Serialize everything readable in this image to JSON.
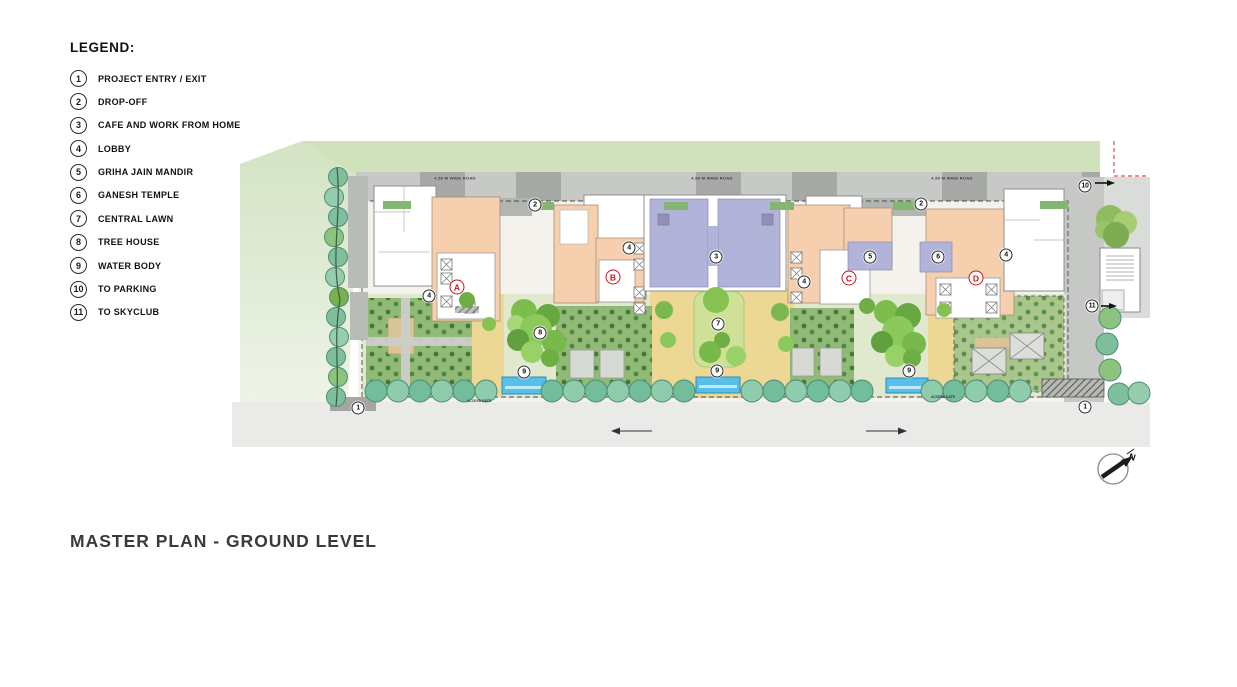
{
  "title": "MASTER PLAN - GROUND LEVEL",
  "legend": {
    "heading": "LEGEND:",
    "items": [
      {
        "num": "1",
        "label": "PROJECT ENTRY / EXIT"
      },
      {
        "num": "2",
        "label": "DROP-OFF"
      },
      {
        "num": "3",
        "label": "CAFE AND WORK FROM HOME"
      },
      {
        "num": "4",
        "label": "LOBBY"
      },
      {
        "num": "5",
        "label": "GRIHA JAIN MANDIR"
      },
      {
        "num": "6",
        "label": "GANESH TEMPLE"
      },
      {
        "num": "7",
        "label": "CENTRAL LAWN"
      },
      {
        "num": "8",
        "label": "TREE HOUSE"
      },
      {
        "num": "9",
        "label": "WATER BODY"
      },
      {
        "num": "10",
        "label": "TO PARKING"
      },
      {
        "num": "11",
        "label": "TO SKYCLUB"
      }
    ]
  },
  "plan": {
    "roads": {
      "dp_road": "18.30 M.   D. P.   R O A D.",
      "highway": "WESTERN EXPRESS HIGHWAY",
      "side_road": "4.50 M WIDE ROAD",
      "gate": "ACCESS GATE"
    },
    "compass_label": "N",
    "number_markers": [
      {
        "label": "1",
        "x": 358,
        "y": 408
      },
      {
        "label": "1",
        "x": 1085,
        "y": 407
      },
      {
        "label": "2",
        "x": 535,
        "y": 205
      },
      {
        "label": "2",
        "x": 921,
        "y": 204
      },
      {
        "label": "3",
        "x": 716,
        "y": 257
      },
      {
        "label": "4",
        "x": 429,
        "y": 296
      },
      {
        "label": "4",
        "x": 629,
        "y": 248
      },
      {
        "label": "4",
        "x": 804,
        "y": 282
      },
      {
        "label": "4",
        "x": 1006,
        "y": 255
      },
      {
        "label": "5",
        "x": 870,
        "y": 257
      },
      {
        "label": "6",
        "x": 938,
        "y": 257
      },
      {
        "label": "7",
        "x": 718,
        "y": 324
      },
      {
        "label": "8",
        "x": 540,
        "y": 333
      },
      {
        "label": "9",
        "x": 524,
        "y": 372
      },
      {
        "label": "9",
        "x": 717,
        "y": 371
      },
      {
        "label": "9",
        "x": 909,
        "y": 371
      },
      {
        "label": "10",
        "x": 1085,
        "y": 186
      },
      {
        "label": "11",
        "x": 1092,
        "y": 306
      }
    ],
    "building_markers": [
      {
        "label": "A",
        "x": 457,
        "y": 287
      },
      {
        "label": "B",
        "x": 613,
        "y": 277
      },
      {
        "label": "C",
        "x": 849,
        "y": 278
      },
      {
        "label": "D",
        "x": 976,
        "y": 278
      }
    ],
    "side_road_labels": [
      {
        "x": 455,
        "y": 178
      },
      {
        "x": 712,
        "y": 178
      },
      {
        "x": 952,
        "y": 178
      }
    ],
    "gate_labels": [
      {
        "x": 479,
        "y": 397
      },
      {
        "x": 943,
        "y": 393
      }
    ]
  },
  "palette": {
    "marker_red": "#c8161d",
    "water_blue": "#58bfe8",
    "lawn_green": "#cfe097",
    "court_green": "#92ba77",
    "backdrop_green": "#cfe2bb",
    "building_peach": "#f6cfae",
    "club_lavender": "#b2b3d8",
    "road_gray": "#c7c9c6",
    "sand_path": "#ecd795",
    "tree_teal": "#72bd9b"
  }
}
